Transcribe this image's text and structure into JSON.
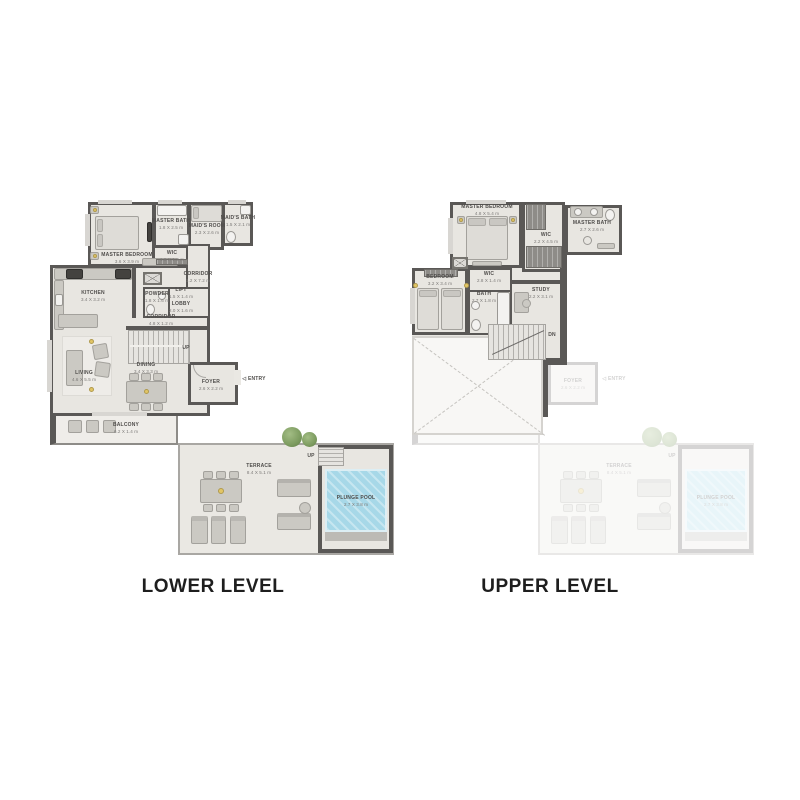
{
  "titles": {
    "lower": "LOWER LEVEL",
    "upper": "UPPER LEVEL"
  },
  "colors": {
    "wall": "#5a5856",
    "floor": "#e8e6e1",
    "floor_light": "#efede9",
    "furn": "#cbc9c3",
    "furn_border": "#a3a19c",
    "dark_unit": "#44423f",
    "closet": "#8e8c88",
    "pool": "#a7d8e8",
    "pool_deck": "#bcbab5",
    "tree": "#7d9c60",
    "text": "#4f4d4b",
    "text_dim": "#7b7977",
    "title": "#1e1e1e"
  },
  "lower": {
    "rooms": {
      "master_bedroom": {
        "name": "MASTER BEDROOM",
        "dims": "3.6 X 3.9 m"
      },
      "master_bath": {
        "name": "MASTER BATH",
        "dims": "1.8 X 2.5 m"
      },
      "wic": {
        "name": "WIC",
        "dims": "1.8 X 1.2 m"
      },
      "maids_room": {
        "name": "MAID'S ROOM",
        "dims": "2.3 X 2.6 m"
      },
      "maids_bath": {
        "name": "MAID'S BATH",
        "dims": "1.5 X 2.1 m"
      },
      "corridor_v": {
        "name": "CORRIDOR",
        "dims": "1.2 X 7.2 m"
      },
      "kitchen": {
        "name": "KITCHEN",
        "dims": "3.4 X 3.2 m"
      },
      "powder": {
        "name": "POWDER",
        "dims": "1.8 X 1.6 m"
      },
      "lift": {
        "name": "LIFT",
        "dims": "1.5 X 1.4 m"
      },
      "lobby": {
        "name": "LOBBY",
        "dims": "2.0 X 1.6 m"
      },
      "corridor_h": {
        "name": "CORRIDOR",
        "dims": "4.8 X 1.2 m"
      },
      "living": {
        "name": "LIVING",
        "dims": "4.6 X 5.5 m"
      },
      "dining": {
        "name": "DINING",
        "dims": "3.4 X 3.3 m"
      },
      "foyer": {
        "name": "FOYER",
        "dims": "2.6 X 2.2 m"
      },
      "balcony": {
        "name": "BALCONY",
        "dims": "6.2 X 1.4 m"
      },
      "terrace": {
        "name": "TERRACE",
        "dims": "8.4 X 5.1 m"
      },
      "plunge_pool": {
        "name": "PLUNGE POOL",
        "dims": "2.7 X 3.8 m"
      }
    },
    "labels": {
      "up": "UP",
      "entry": "ENTRY",
      "entry_arrow": "◁"
    }
  },
  "upper": {
    "rooms": {
      "master_bedroom": {
        "name": "MASTER BEDROOM",
        "dims": "4.8 X 5.4 m"
      },
      "wic": {
        "name": "WIC",
        "dims": "2.2 X 4.5 m"
      },
      "master_bath": {
        "name": "MASTER BATH",
        "dims": "2.7 X 2.6 m"
      },
      "bedroom": {
        "name": "BEDROOM",
        "dims": "3.2 X 3.4 m"
      },
      "wic2": {
        "name": "WIC",
        "dims": "2.8 X 1.4 m"
      },
      "bath": {
        "name": "BATH",
        "dims": "2.7 X 1.8 m"
      },
      "study": {
        "name": "STUDY",
        "dims": "2.2 X 3.1 m"
      }
    },
    "labels": {
      "dn": "DN"
    }
  }
}
